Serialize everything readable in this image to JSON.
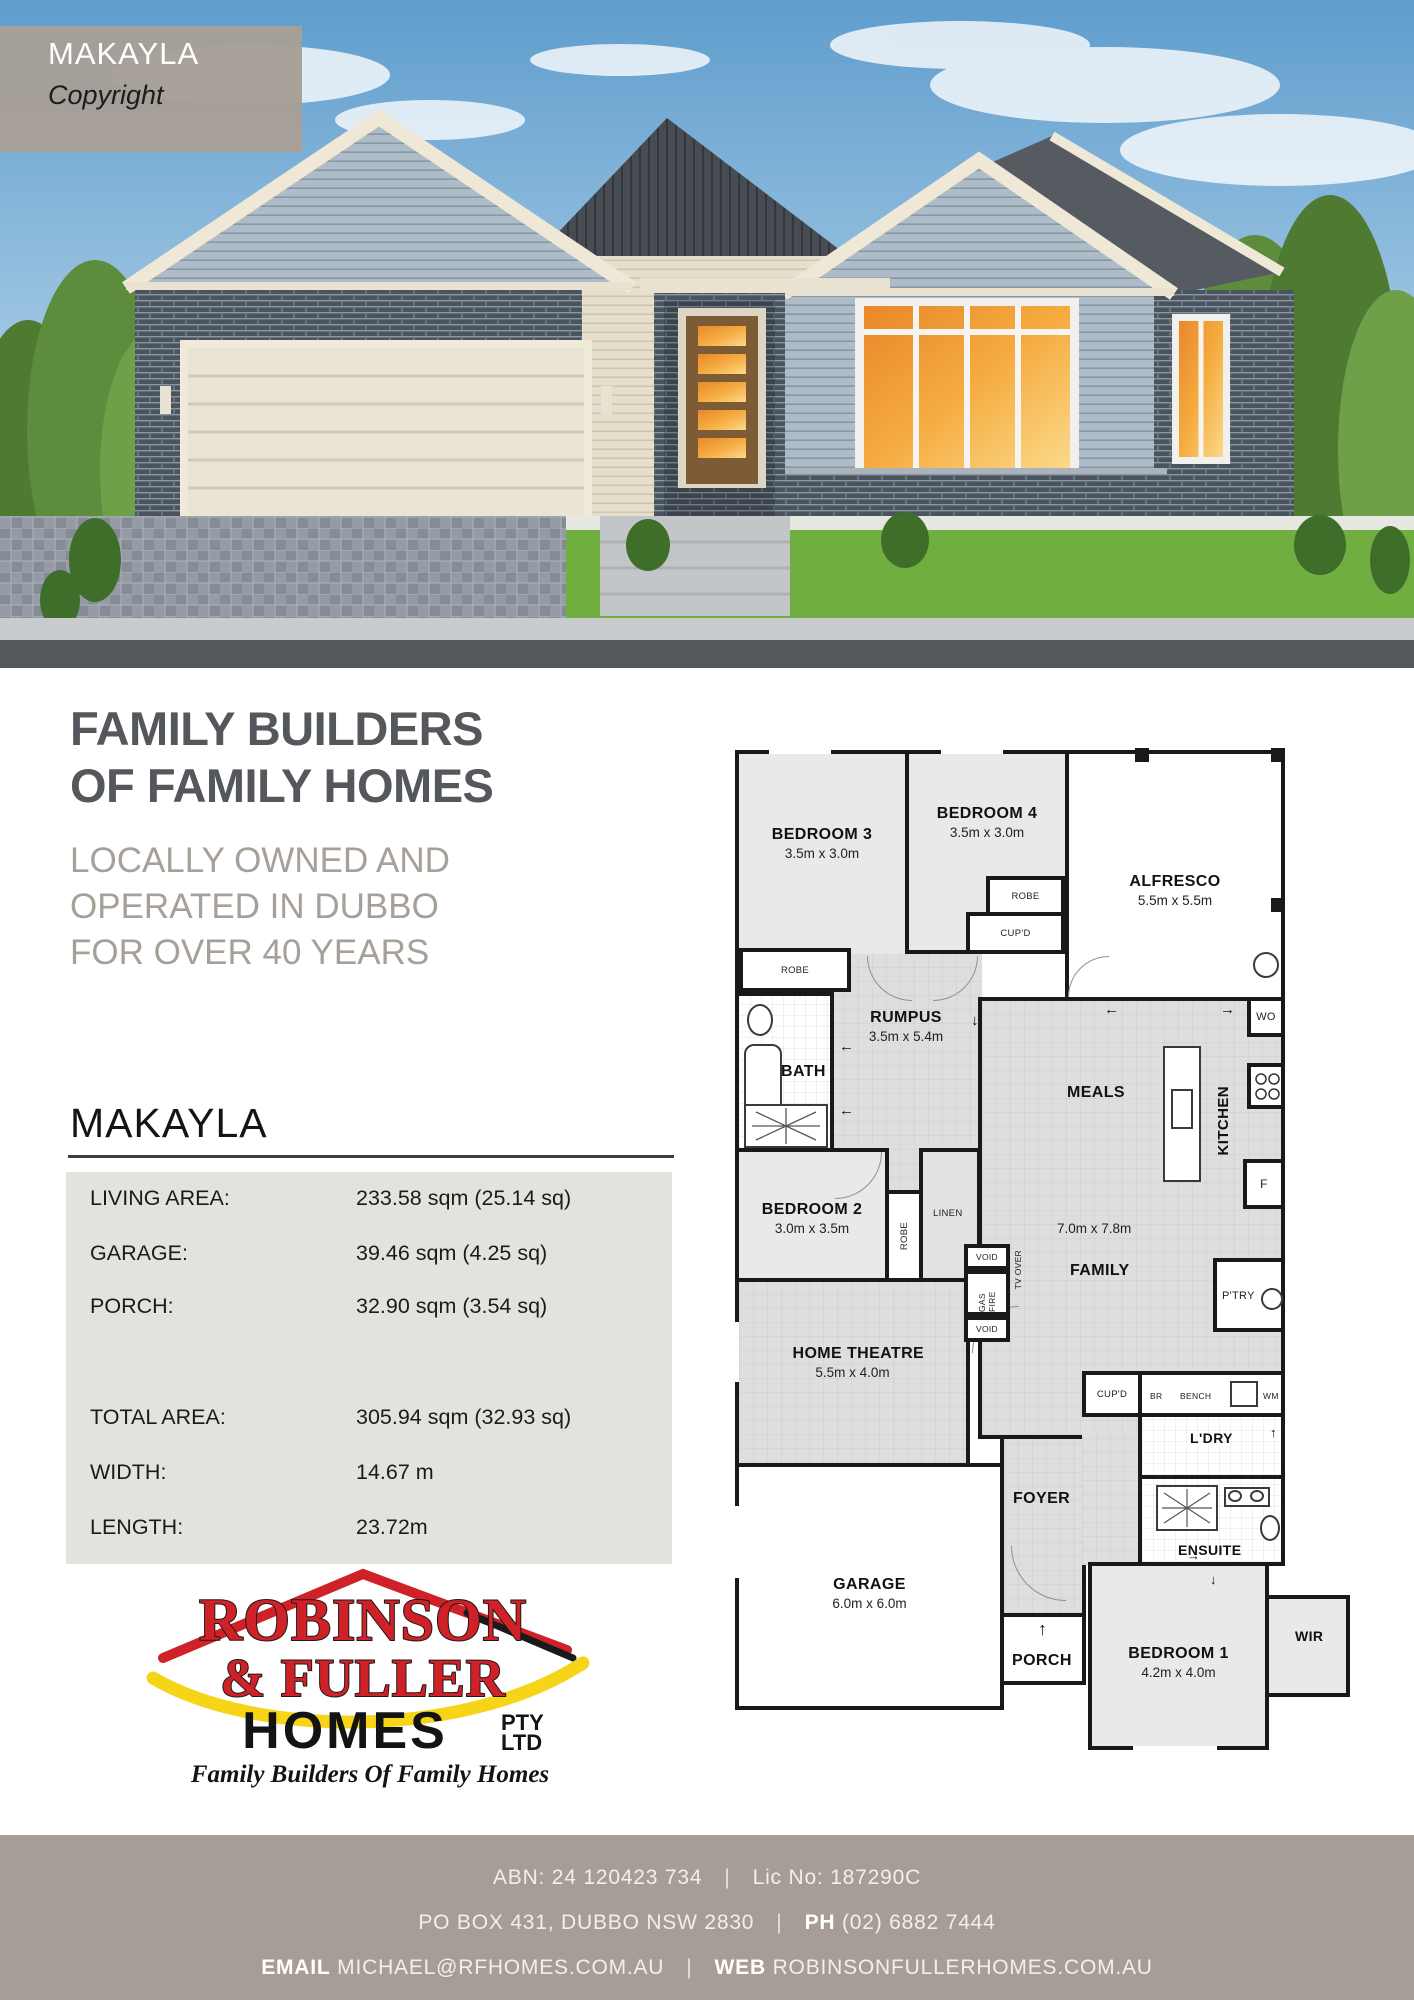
{
  "photo": {
    "label_title": "MAKAYLA",
    "label_copyright": "Copyright"
  },
  "headline": {
    "line1": "FAMILY BUILDERS",
    "line2": "OF FAMILY HOMES"
  },
  "subheadline": {
    "line1": "LOCALLY OWNED AND",
    "line2": "OPERATED IN DUBBO",
    "line3": "FOR OVER 40 YEARS"
  },
  "plan_title": "MAKAYLA",
  "specs": {
    "rows": [
      {
        "label": "LIVING AREA:",
        "value": "233.58 sqm (25.14 sq)"
      },
      {
        "label": "GARAGE:",
        "value": "39.46 sqm (4.25 sq)"
      },
      {
        "label": "PORCH:",
        "value": "32.90 sqm (3.54 sq)"
      },
      {
        "label": "TOTAL AREA:",
        "value": "305.94 sqm (32.93 sq)"
      },
      {
        "label": "WIDTH:",
        "value": "14.67 m"
      },
      {
        "label": "LENGTH:",
        "value": "23.72m"
      }
    ]
  },
  "floorplan": {
    "rooms": {
      "bedroom3": {
        "name": "BEDROOM 3",
        "dims": "3.5m x 3.0m"
      },
      "bedroom4": {
        "name": "BEDROOM 4",
        "dims": "3.5m x 3.0m"
      },
      "alfresco": {
        "name": "ALFRESCO",
        "dims": "5.5m x 5.5m"
      },
      "rumpus": {
        "name": "RUMPUS",
        "dims": "3.5m x 5.4m"
      },
      "bath": {
        "name": "BATH"
      },
      "bedroom2": {
        "name": "BEDROOM 2",
        "dims": "3.0m x 3.5m"
      },
      "meals": {
        "name": "MEALS"
      },
      "family": {
        "name": "FAMILY"
      },
      "kitchen": {
        "name": "KITCHEN"
      },
      "open_plan_dims": "7.0m x 7.8m",
      "home_theatre": {
        "name": "HOME THEATRE",
        "dims": "5.5m x 4.0m"
      },
      "garage": {
        "name": "GARAGE",
        "dims": "6.0m x 6.0m"
      },
      "foyer": {
        "name": "FOYER"
      },
      "porch": {
        "name": "PORCH"
      },
      "laundry": {
        "name": "L'DRY"
      },
      "ensuite": {
        "name": "ENSUITE"
      },
      "bedroom1": {
        "name": "BEDROOM 1",
        "dims": "4.2m x 4.0m"
      },
      "wir": {
        "name": "WIR"
      },
      "pantry": {
        "name": "P'TRY"
      }
    },
    "labels": {
      "robe": "ROBE",
      "cupd": "CUP'D",
      "linen": "LINEN",
      "void": "VOID",
      "gas_fire": "GAS FIRE",
      "tv_over": "TV OVER",
      "wall_oven": "WO",
      "fridge": "F",
      "br": "BR",
      "bench": "BENCH",
      "wm": "WM"
    },
    "symbols": {
      "up": "↑",
      "down": "↓",
      "left": "←",
      "right": "→"
    }
  },
  "logo": {
    "name_line1": "ROBINSON",
    "name_line2": "& FULLER",
    "homes": "HOMES",
    "pty": "PTY",
    "ltd": "LTD",
    "tagline": "Family  Builders  Of  Family  Homes"
  },
  "footer": {
    "abn": "ABN: 24 120423 734",
    "sep": "|",
    "lic": "Lic No: 187290C",
    "address": "PO BOX 431, DUBBO NSW 2830",
    "ph_label": "PH",
    "phone": "(02) 6882 7444",
    "email_label": "EMAIL",
    "email": "MICHAEL@RFHOMES.COM.AU",
    "web_label": "WEB",
    "web": "ROBINSONFULLERHOMES.COM.AU"
  }
}
